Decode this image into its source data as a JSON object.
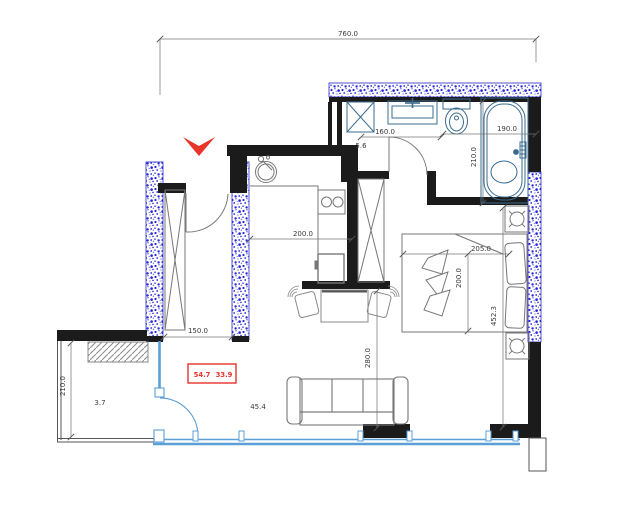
{
  "plan_title": "apartment floor plan",
  "colors": {
    "wall": "#1b1b1b",
    "hatch_blue": "#2a2ac8",
    "fixture_blue": "#3a6b8f",
    "window_blue": "#5b9fd6",
    "accent_red": "#e8342a",
    "furniture_gray": "#777777"
  },
  "labels": {
    "dim_total_width": "760.0",
    "dim_vanity": "160.0",
    "area_bathroom": "5.6",
    "dim_bath_width": "190.0",
    "dim_bath_depth": "210.0",
    "dim_kitchen": "200.0",
    "dim_hall": "150.0",
    "dim_bed_length": "205.0",
    "dim_bed_width": "200.0",
    "dim_bedroom_depth": "452.3",
    "dim_living_depth": "280.0",
    "dim_balcony_depth": "210.0",
    "area_balcony": "3.7",
    "area_living": "45.4",
    "area_total": "54.7",
    "area_secondary": "33.9"
  }
}
